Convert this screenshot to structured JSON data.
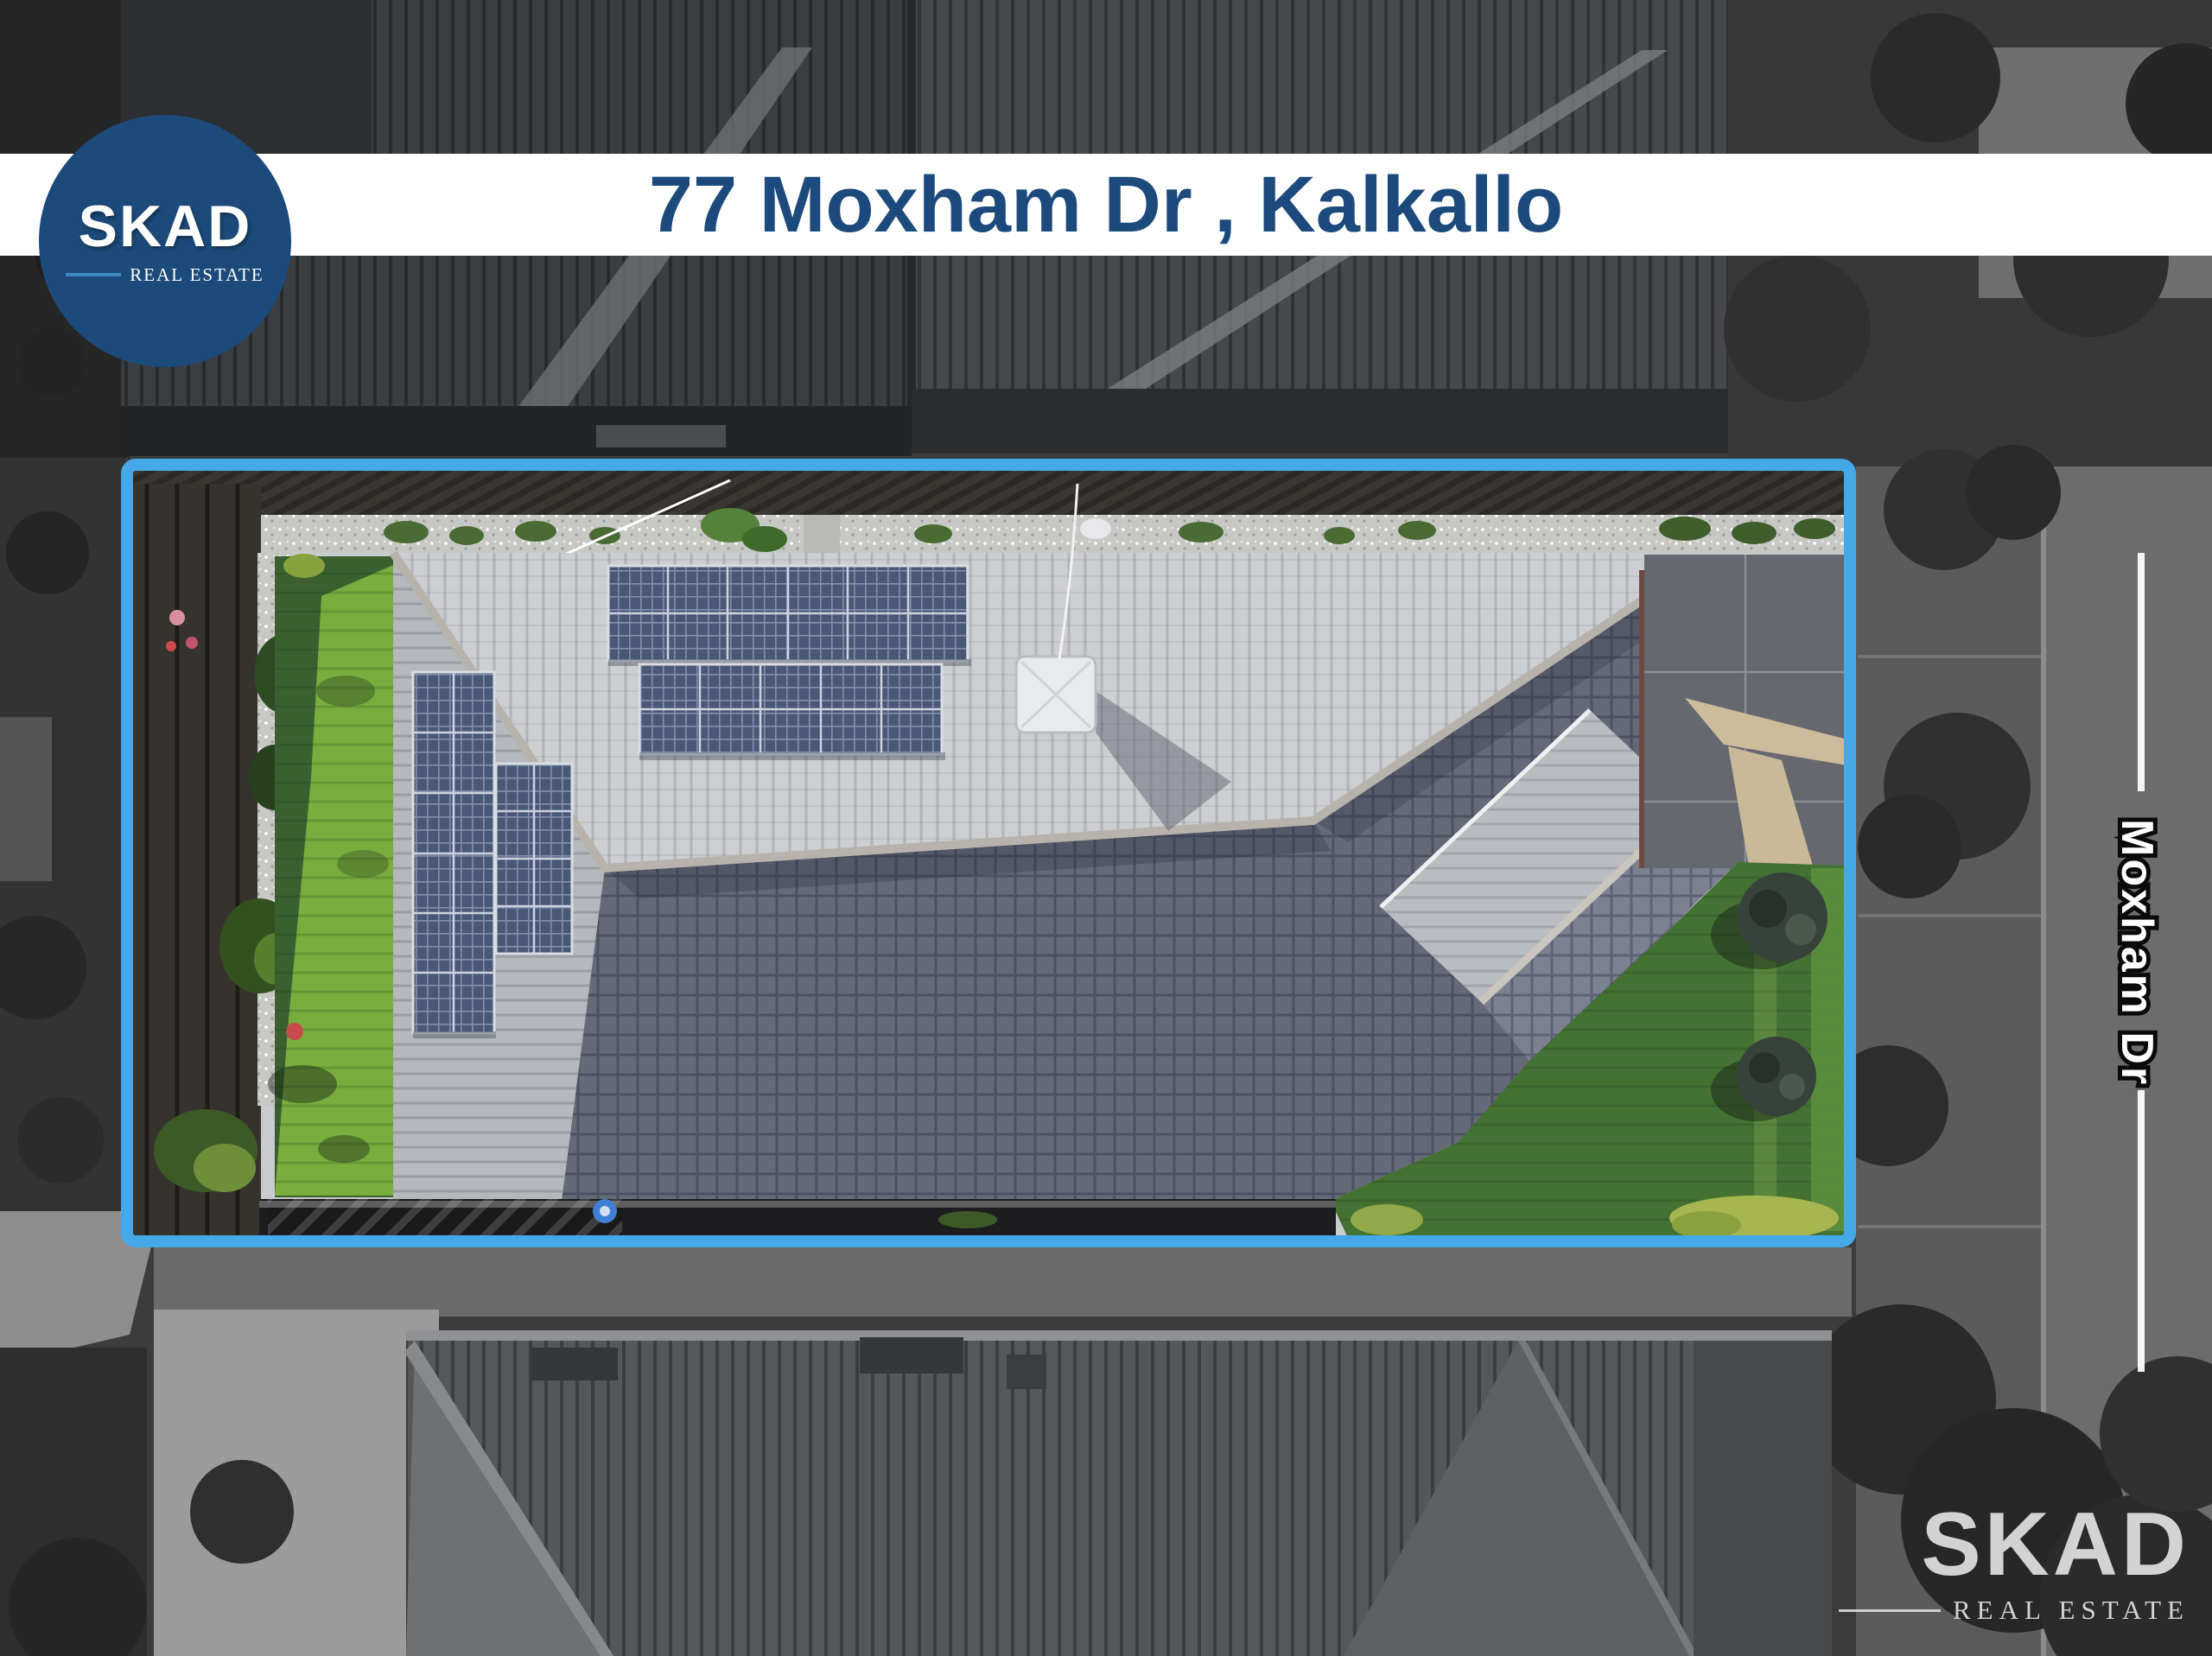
{
  "banner": {
    "title": "77 Moxham Dr , Kalkallo"
  },
  "brand": {
    "name": "SKAD",
    "tagline": "REAL ESTATE"
  },
  "watermark": {
    "name": "SKAD",
    "tagline": "REAL ESTATE"
  },
  "road": {
    "label": "Moxham Dr"
  },
  "colors": {
    "navy": "#1d4a7c",
    "accent": "#45a9e8",
    "logo-circle": "#1c4b7b",
    "logo-underline": "#3e88c0",
    "banner-bg": "#ffffff",
    "watermark": "#dcdcdc"
  }
}
